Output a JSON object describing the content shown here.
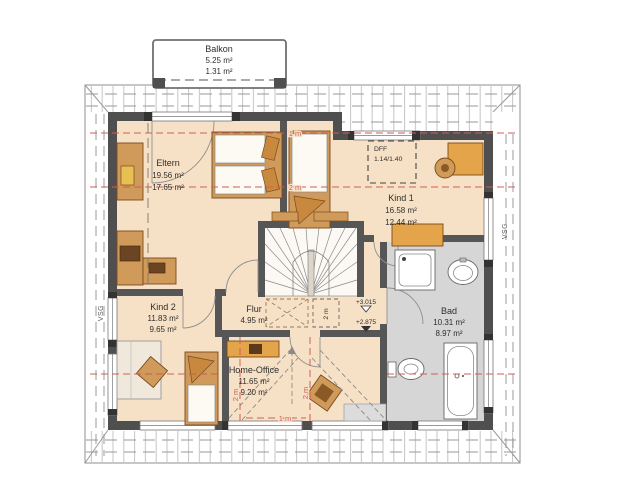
{
  "drawing": {
    "type": "floor-plan",
    "rooms": [
      {
        "name": "Balkon",
        "area": "5.25 m²",
        "reduced": "1.31 m²"
      },
      {
        "name": "Eltern",
        "area": "19.56 m²",
        "reduced": "17.65 m²"
      },
      {
        "name": "Kind 1",
        "area": "16.58 m²",
        "reduced": "12.44 m²"
      },
      {
        "name": "Kind 2",
        "area": "11.83 m²",
        "reduced": "9.65 m²"
      },
      {
        "name": "Flur",
        "area": "4.95 m²"
      },
      {
        "name": "Bad",
        "area": "10.31 m²",
        "reduced": "8.97 m²"
      },
      {
        "name": "Home-Office",
        "area": "11.65 m²",
        "reduced": "9.20 m²"
      }
    ],
    "annotations": {
      "roof_window": {
        "label": "DFF",
        "size": "1.14/1.40"
      },
      "levels": {
        "upper": "+3.015",
        "lower": "+2.875"
      },
      "glazing_label": "VSG",
      "height_lines": {
        "one_meter": "1 m",
        "two_meters": "2 m"
      }
    },
    "colors": {
      "floor": "#f7e1c6",
      "bathroom_floor": "#d6d6d6",
      "walls": "#4f4f4f",
      "furniture_wood": "#cf9a5a",
      "furniture_accent": "#e4a449",
      "height_line_red": "#cd5f55"
    }
  }
}
